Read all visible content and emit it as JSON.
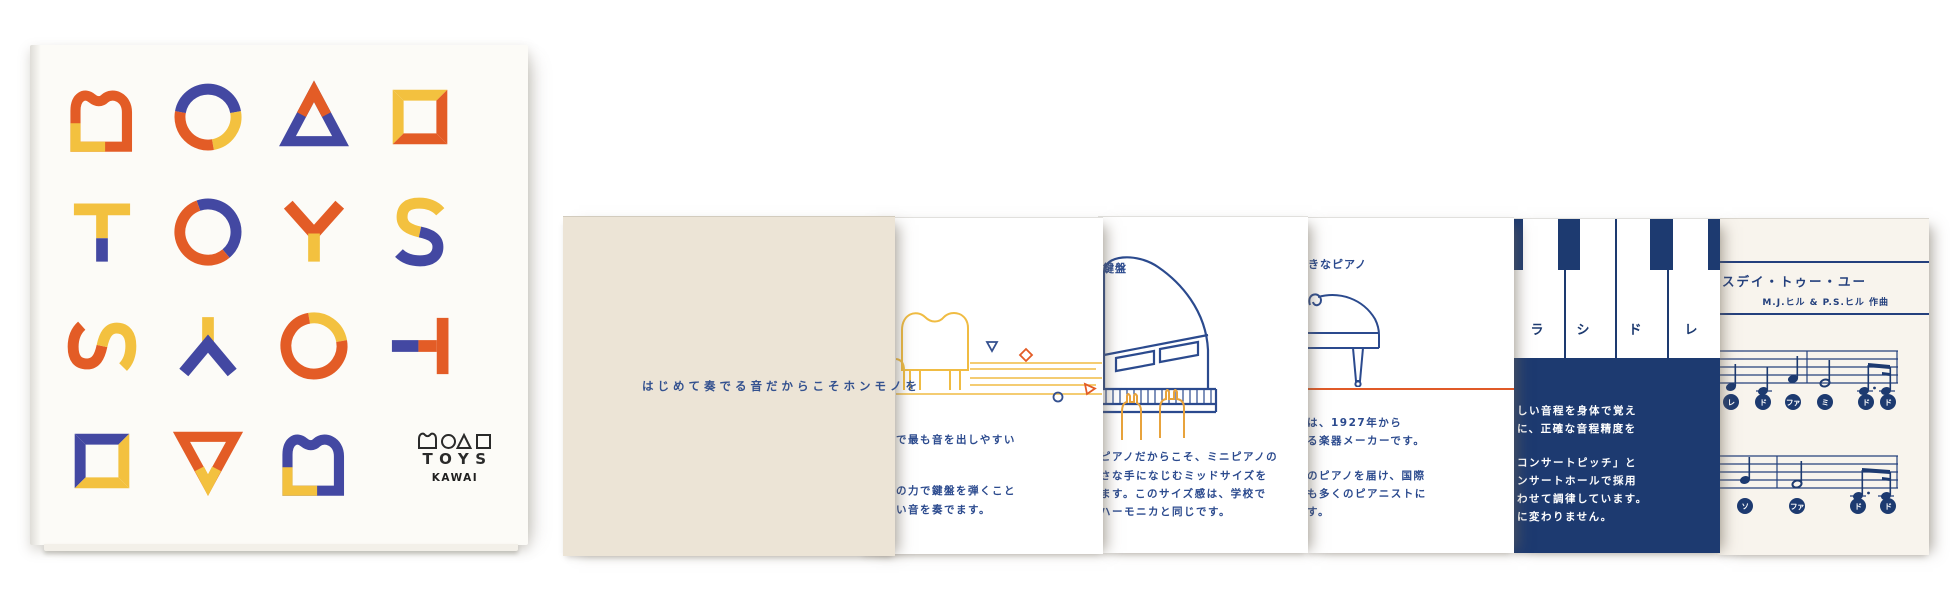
{
  "colors": {
    "orange": "#E35C26",
    "yellow": "#F3C13F",
    "indigo": "#4348A2",
    "navy_text": "#2B4A8E",
    "navy_dark": "#1D3A70",
    "beige": "#ECE4D6",
    "cream": "#F8F4ED",
    "ink": "#2a2a2a"
  },
  "cover": {
    "grid_rows": [
      [
        "grand-piano-outline",
        "circle",
        "triangle",
        "square"
      ],
      [
        "letter-T",
        "letter-O",
        "letter-Y",
        "letter-S"
      ],
      [
        "letter-S-rotated",
        "letter-Y-inverted",
        "letter-O",
        "letter-T-rotated"
      ],
      [
        "square",
        "triangle-inverted",
        "grand-piano-outline",
        "logo-block"
      ]
    ],
    "logo": {
      "shape_icons": [
        "piano-icon",
        "circle-icon",
        "triangle-icon",
        "square-icon"
      ],
      "wordmark": "TOYS",
      "brand": "KAWAI"
    }
  },
  "pages": {
    "intro": {
      "tagline": "はじめて奏でる音だからこそホンモノを"
    },
    "sound": {
      "lines": [
        "で最も音を出しやすい",
        "の力で鍵盤を弾くこと",
        "い音を奏でます。"
      ]
    },
    "size": {
      "keyboard_label": "鍵盤",
      "lines": [
        "ピアノだからこそ、ミニピアノの",
        "さな手になじむミッドサイズを",
        "ます。このサイズ感は、学校で",
        "ハーモニカと同じです。"
      ]
    },
    "maker": {
      "piano_label": "きなピアノ",
      "lines": [
        "は、1927年から",
        "る楽器メーカーです。",
        "のピアノを届け、国際",
        "も多くのピアニストに",
        "す。"
      ]
    },
    "pitch": {
      "key_labels": [
        "ラ",
        "シ",
        "ド",
        "レ"
      ],
      "lines": [
        "しい音程を身体で覚え",
        "に、正確な音程精度を",
        "コンサートピッチ」と",
        "ンサートホールで採用",
        "わせて調律しています。",
        "に変わりません。"
      ]
    },
    "score": {
      "title": "スデイ・トゥー・ユー",
      "credit": "M.J.ヒル & P.S.ヒル 作曲",
      "staff1_note_names": [
        "レ",
        "ド",
        "ファ",
        "ミ",
        "ド",
        "ド"
      ],
      "staff2_note_names": [
        "ソ",
        "ファ",
        "ド",
        "ド"
      ]
    }
  }
}
